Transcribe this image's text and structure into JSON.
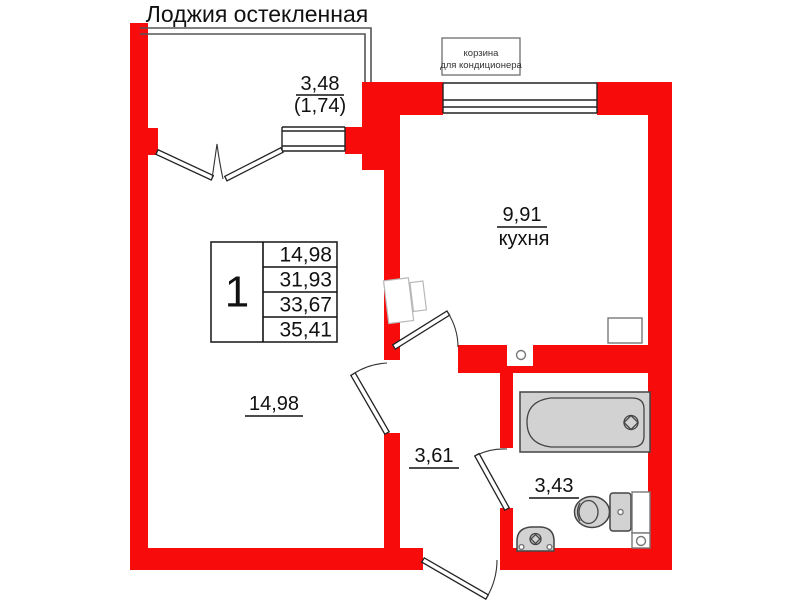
{
  "plan": {
    "title": "Лоджия остекленная",
    "ac_basket": {
      "line1": "корзина",
      "line2": "для кондиционера"
    },
    "rooms": {
      "loggia": {
        "area": "3,48",
        "area_coef": "(1,74)"
      },
      "kitchen": {
        "area": "9,91",
        "name": "кухня"
      },
      "living": {
        "area": "14,98"
      },
      "hallway": {
        "area": "3,61"
      },
      "bathroom": {
        "area": "3,43"
      }
    },
    "info_table": {
      "rooms_count": "1",
      "rows": [
        "14,98",
        "31,93",
        "33,67",
        "35,41"
      ]
    },
    "colors": {
      "wall": "#f80b0b",
      "line": "#1c1c1c",
      "fixture_fill": "#d2d2d2"
    }
  }
}
